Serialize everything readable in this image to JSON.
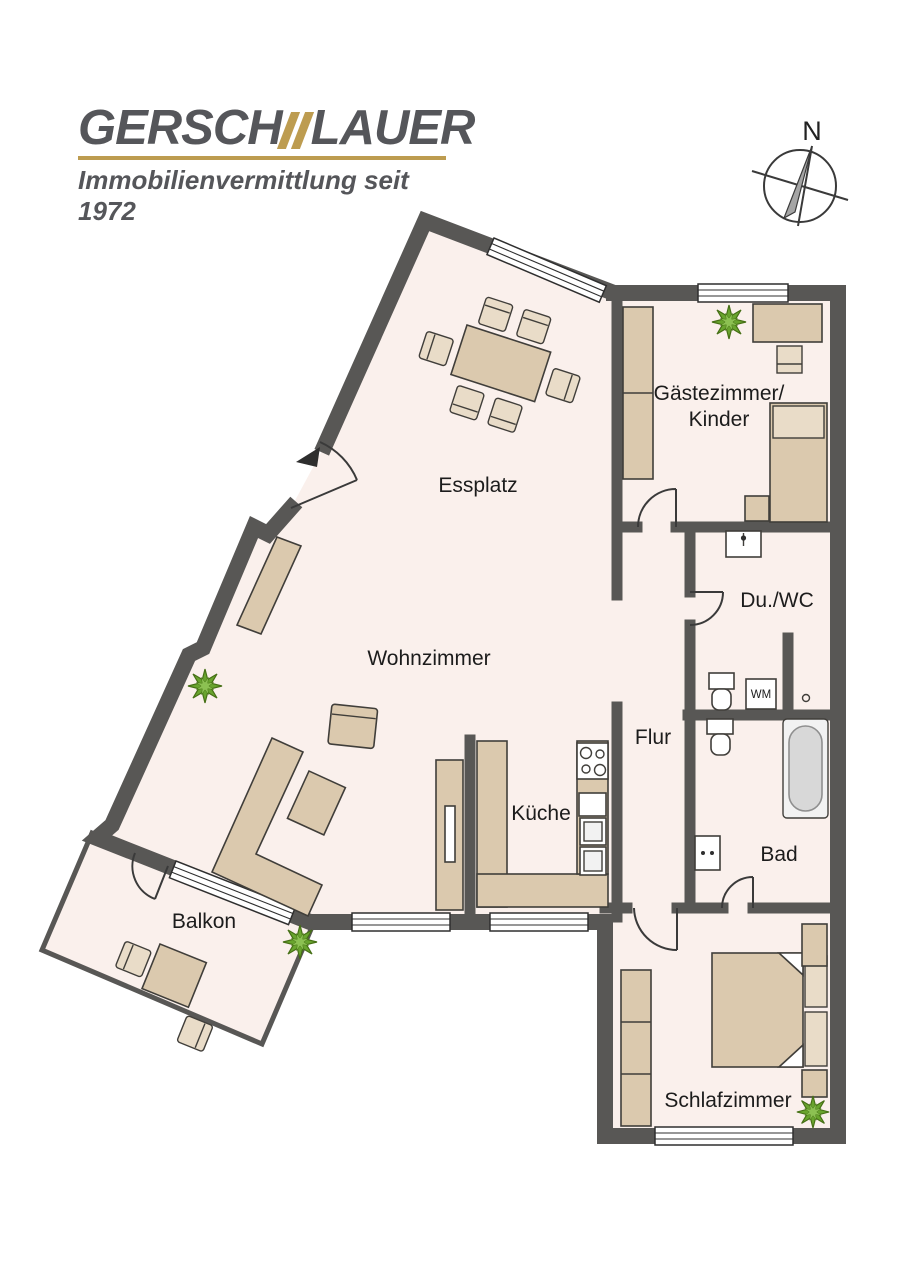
{
  "brand": {
    "left": "GERSCH",
    "right": "LAUER",
    "tagline": "Immobilienvermittlung seit 1972",
    "accent_color": "#bd9c50",
    "text_color": "#55565a"
  },
  "compass": {
    "north_label": "N"
  },
  "rooms": [
    {
      "name": "essplatz",
      "label": "Essplatz"
    },
    {
      "name": "wohnzimmer",
      "label": "Wohnzimmer"
    },
    {
      "name": "gaestezimmer",
      "label": "Gästezimmer/",
      "label2": "Kinder"
    },
    {
      "name": "du-wc",
      "label": "Du./WC"
    },
    {
      "name": "flur",
      "label": "Flur"
    },
    {
      "name": "kueche",
      "label": "Küche"
    },
    {
      "name": "bad",
      "label": "Bad"
    },
    {
      "name": "balkon",
      "label": "Balkon"
    },
    {
      "name": "schlafzimmer",
      "label": "Schlafzimmer"
    }
  ],
  "labels": {
    "washing_machine": "WM"
  },
  "colors": {
    "wall": "#585755",
    "floor": "#faf0ec",
    "furniture": "#dbc9ae",
    "furniture_light": "#e9dcc8",
    "plant_green": "#69a42e",
    "accent_gold": "#bd9c50"
  }
}
